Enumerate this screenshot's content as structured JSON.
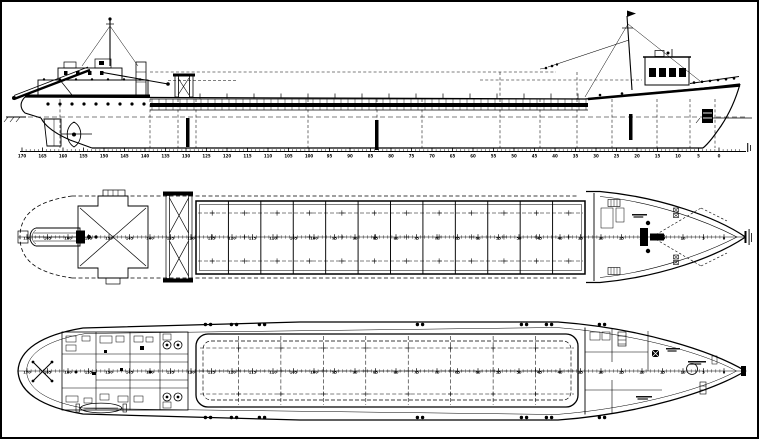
{
  "colors": {
    "ink": "#000000",
    "paper": "#ffffff"
  },
  "frame_scale": {
    "start": 170,
    "end": 0,
    "step": 5,
    "labels": [
      "170",
      "165",
      "160",
      "155",
      "150",
      "145",
      "140",
      "135",
      "130",
      "125",
      "120",
      "115",
      "110",
      "105",
      "100",
      "95",
      "90",
      "85",
      "80",
      "75",
      "70",
      "65",
      "60",
      "55",
      "50",
      "45",
      "40",
      "35",
      "30",
      "25",
      "20",
      "15",
      "10",
      "5",
      "0"
    ]
  },
  "views": {
    "profile": {
      "id": "side-profile"
    },
    "main_deck": {
      "id": "main-deck-plan",
      "hatch_panels": 12,
      "grid_rows": 3
    },
    "lower_deck": {
      "id": "lower-deck-plan",
      "hold_divisions": 9,
      "grid_rows": 3
    }
  }
}
